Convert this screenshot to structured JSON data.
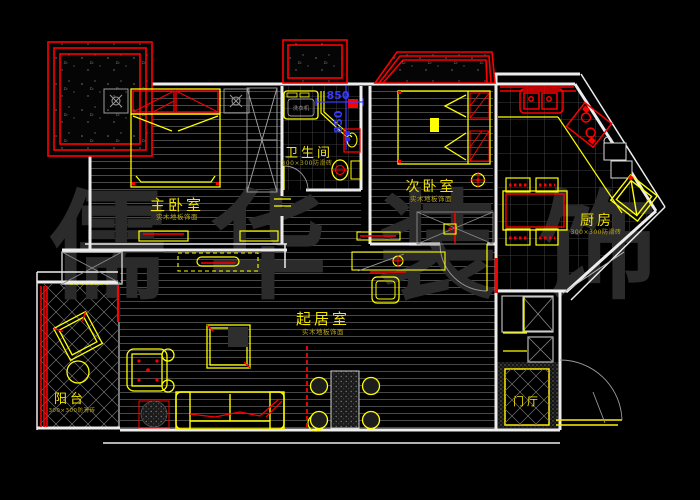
{
  "drawing": {
    "type": "apartment-floor-plan-cad",
    "background": "#000000"
  },
  "watermark": {
    "chars": [
      "儒",
      "华",
      "装",
      "饰"
    ],
    "color": "#2b2b2b"
  },
  "rooms": {
    "master_bedroom": {
      "name": "主卧室",
      "finish": "实木地板饰面"
    },
    "bathroom": {
      "name": "卫生间",
      "finish": "300×300防滑砖"
    },
    "second_bedroom": {
      "name": "次卧室",
      "finish": "实木地板饰面"
    },
    "kitchen": {
      "name": "厨房",
      "finish": "300×300防滑砖"
    },
    "living_room": {
      "name": "起居室",
      "finish": "实木地板饰面"
    },
    "balcony": {
      "name": "阳台",
      "finish": "300×300防滑砖"
    },
    "foyer": {
      "name": "门厅"
    }
  },
  "dimensions": {
    "d1": "850",
    "d2": "850"
  },
  "appliances": {
    "washer": "洗衣机"
  },
  "colors": {
    "furniture": "#ffff00",
    "accent": "#ff0000",
    "walls": "#ededed",
    "dimension": "#3b3bff",
    "labels": "#f2e400",
    "watermark": "#2b2b2b"
  }
}
